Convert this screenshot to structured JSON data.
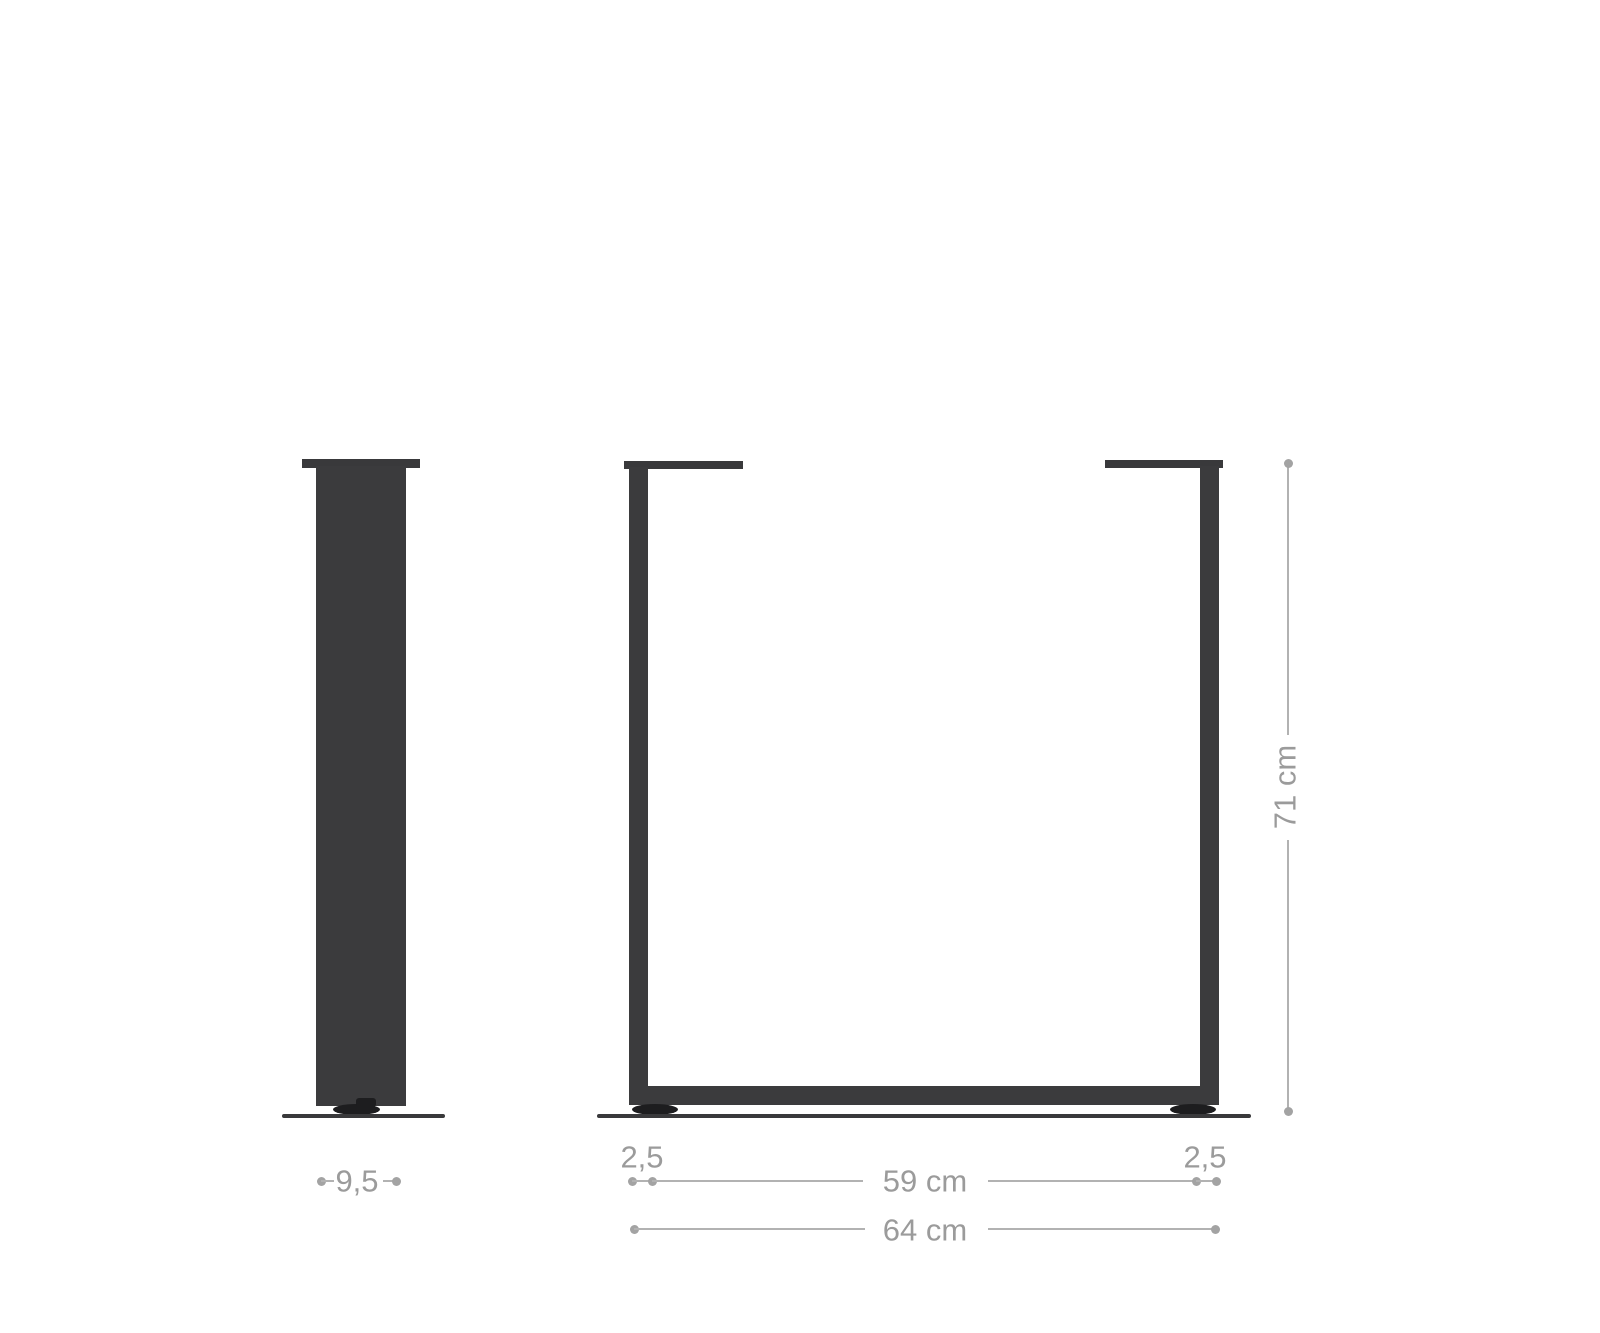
{
  "diagram": {
    "description": "product dimension drawing of U-shaped metal table frame legs, side profile view and front view on a floor line",
    "labels": {
      "side_profile_width": "9,5",
      "front_left_profile_thickness": "2,5",
      "front_right_profile_thickness": "2,5",
      "front_inner_width": "59 cm",
      "front_outer_width": "64 cm",
      "front_height": "71 cm"
    }
  },
  "colors": {
    "background": "#ffffff",
    "metal": "#3b3b3d",
    "metal_dark": "#39393b",
    "foot": "#1d1d1f",
    "dim_text": "#9b9b9b",
    "dim_line": "#b2b2b2",
    "dim_dot": "#a3a3a3"
  }
}
